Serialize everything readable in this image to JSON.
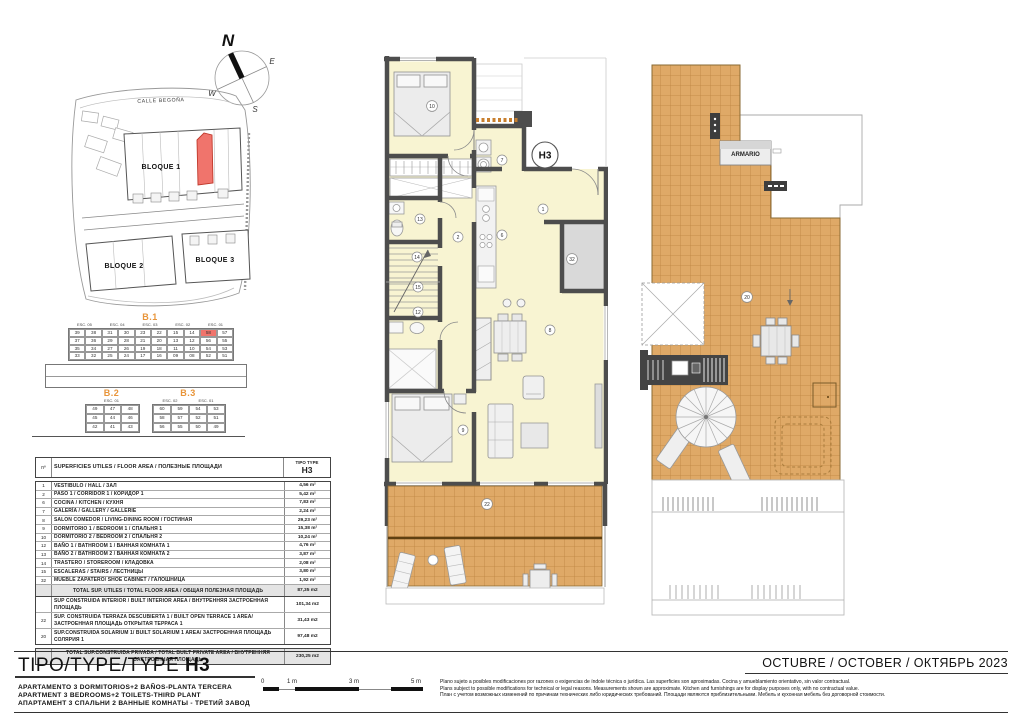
{
  "page": {
    "date_label": "OCTUBRE / OCTOBER / ОКТЯБРЬ  2023",
    "disclaimer": {
      "es": "Plano sujeto a posibles modificaciones por razones o exigencias de índole técnica o jurídica. Las superficies son aproximadas. Cocina y amueblamiento orientativo, sin valor contractual.",
      "en": "Plans subject to possible modifications for technical or legal reasons. Measurements shown are approximate. Kitchen and furnishings are for display purposes only, with no contractual value.",
      "ru": "План с учетом возможных изменений по причинам технических либо юридических требований. Площади являются приблизительными. Мебель и кухонная мебель без договорной стоимости."
    }
  },
  "title_block": {
    "type_label": "TIPO/TYPE/TYPE",
    "type_code": "H3",
    "subtitle_es": "APARTAMENTO 3 DORMITORIOS+2 BAÑOS-PLANTA TERCERA",
    "subtitle_en": "APARTMENT 3 BEDROOMS+2 TOILETS-THIRD PLANT",
    "subtitle_ru": "АПАРТАМЕНТ 3 СПАЛЬНИ 2 ВАННЫЕ КОМНАТЫ - ТРЕТИЙ ЗАВОД"
  },
  "scale_bar": {
    "labels": [
      "0",
      "1 m",
      "3 m",
      "5 m"
    ]
  },
  "compass": {
    "n": "N",
    "e": "E",
    "s": "S",
    "w": "W"
  },
  "site_plan": {
    "street": "CALLE BEGOÑA",
    "block1": "BLOQUE 1",
    "block2": "BLOQUE 2",
    "block3": "BLOQUE 3",
    "highlight_color": "#f0746c"
  },
  "block_tables": {
    "b1": {
      "title": "B.1",
      "esc_headers": [
        "ESC. 05",
        "ESC. 04",
        "ESC. 03",
        "ESC. 02",
        "ESC. 01"
      ],
      "rows": [
        [
          "39",
          "38",
          "31",
          "30",
          "23",
          "22",
          "15",
          "14",
          "58",
          "57"
        ],
        [
          "37",
          "36",
          "29",
          "28",
          "21",
          "20",
          "13",
          "12",
          "56",
          "55"
        ],
        [
          "35",
          "34",
          "27",
          "26",
          "19",
          "18",
          "11",
          "10",
          "54",
          "53"
        ],
        [
          "33",
          "32",
          "25",
          "24",
          "17",
          "16",
          "09",
          "08",
          "52",
          "51"
        ]
      ],
      "highlight": {
        "row": 0,
        "col": 8
      }
    },
    "b2": {
      "title": "B.2",
      "esc_headers": [
        "ESC. 01"
      ],
      "rows": [
        [
          "49",
          "47",
          "48"
        ],
        [
          "45",
          "44",
          "46"
        ],
        [
          "42",
          "41",
          "43"
        ]
      ]
    },
    "b3": {
      "title": "B.3",
      "esc_headers": [
        "ESC. 02",
        "ESC. 01"
      ],
      "rows": [
        [
          "60",
          "59",
          "54",
          "53"
        ],
        [
          "58",
          "57",
          "52",
          "51"
        ],
        [
          "56",
          "55",
          "50",
          "49"
        ]
      ]
    }
  },
  "areas_table": {
    "header_no": "nº",
    "header_desc": "SUPERFICIES UTILES / FLOOR AREA / ПОЛЕЗНЫЕ ПЛОЩАДИ",
    "header_type": "TIPO TYPE",
    "header_type_code": "H3",
    "rows": [
      {
        "no": "1",
        "desc": "VESTIBULO / HALL / ЗАЛ",
        "area": "4,56 m²"
      },
      {
        "no": "2",
        "desc": "PASO 1 / CORRIDOR 1 / КОРИДОР 1",
        "area": "5,42 m²"
      },
      {
        "no": "6",
        "desc": "COCINA / KITCHEN / КУХНЯ",
        "area": "7,83 m²"
      },
      {
        "no": "7",
        "desc": "GALERÍA / GALLERY / GALLERIE",
        "area": "2,24 m²"
      },
      {
        "no": "8",
        "desc": "SALON COMEDOR  / LIVING-DINING ROOM / ГОСТИНАЯ",
        "area": "29,23 m²"
      },
      {
        "no": "9",
        "desc": "DORMITORIO 1 / BEDROOM 1 / СПАЛЬНЯ 1",
        "area": "15,38 m²"
      },
      {
        "no": "10",
        "desc": "DORMITORIO 2 / BEDROOM 2 / СПАЛЬНЯ 2",
        "area": "10,24 m²"
      },
      {
        "no": "12",
        "desc": "BAÑO 1 / BATHROOM 1 / ВАННАЯ КОМНАТА 1",
        "area": "4,76 m²"
      },
      {
        "no": "13",
        "desc": "BAÑO 2 / BATHROOM 2 / ВАННАЯ КОМНАТА 2",
        "area": "3,87 m²"
      },
      {
        "no": "14",
        "desc": "TRASTERO / STOREROOM / КЛАДОВКА",
        "area": "2,08 m²"
      },
      {
        "no": "15",
        "desc": "ESCALERAS / STAIRS / ЛЕСТНИЦЫ",
        "area": "3,80 m²"
      },
      {
        "no": "32",
        "desc": "MUEBLE ZAPATERO/ SHOE CABINET / ГАЛОШНИЦА",
        "area": "1,92 m²"
      }
    ],
    "totals": [
      {
        "no": "",
        "desc": "TOTAL SUP. UTILES / TOTAL FLOOR AREA / ОБЩАЯ ПОЛЕЗНАЯ ПЛОЩАДЬ",
        "area": "87,35 m2"
      },
      {
        "no": "",
        "desc": "SUP CONSTRUIDA INTERIOR / BUILT INTERIOR AREA / ВНУТРЕННЯЯ ЗАСТРОЕННАЯ  ПЛОЩАДЬ",
        "area": "101,34 m2"
      },
      {
        "no": "22",
        "desc": "SUP. CONSTRUIDA TERRAZA DESCUBIERTA 1 / BUILT OPEN TERRACE 1 AREA/  ЗАСТРОЕННАЯ ПЛОЩАДЬ ОТКРЫТАЯ ТЕРРАСА  1",
        "area": "31,43 m2"
      },
      {
        "no": "20",
        "desc": "SUP.CONSTRUIDA SOLARIUM 1/ BUILT SOLARIUM 1 AREA/  ЗАСТРОЕННАЯ ПЛОЩАДЬ СОЛЯРИЯ  1",
        "area": "97,48 m2"
      },
      {
        "no": "",
        "desc": "TOTAL SUP.CONSTRUIDA PRIVADA / TOTAL  BUILT PRIVATE AREA / ВНУТРЕННЯЯ ЗАСТРОЕННАЯ ПЛОЩАДЬ",
        "area": "230,25 m2"
      }
    ]
  },
  "floor_plan": {
    "unit_label": "H3",
    "room_labels": {
      "r1": "1",
      "r2": "2",
      "r6": "6",
      "r7": "7",
      "r8": "8",
      "r9": "9",
      "r10": "10",
      "r12": "12",
      "r13": "13",
      "r14": "14",
      "r15": "15",
      "r22": "22",
      "r32": "32"
    },
    "colors": {
      "wall": "#4d4d4d",
      "floor": "#f8f4d2",
      "tile": "#dfa967",
      "tile_line": "#bc8440",
      "highlight": "#f0746c",
      "header_orange": "#e8953a"
    }
  },
  "solarium_plan": {
    "room_label": "20",
    "armario_label": "ARMARIO"
  }
}
